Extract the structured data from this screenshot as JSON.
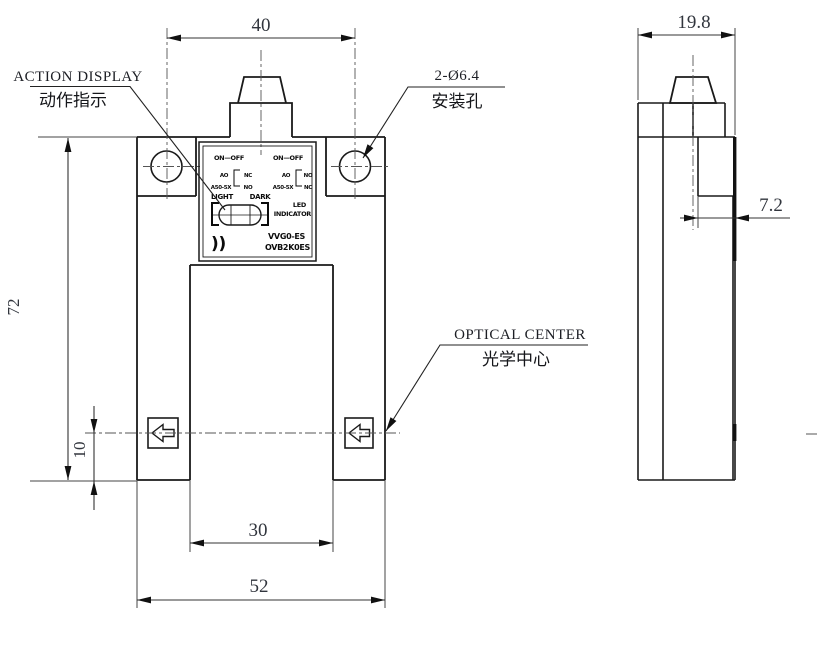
{
  "canvas": {
    "background": "#ffffff"
  },
  "colors": {
    "object_line": "#1a1a1a",
    "thin_line": "#454545",
    "centerline": "#555555",
    "dim_text": "#31353d"
  },
  "dims": {
    "hole_pitch": "40",
    "height": "72",
    "optical_offset": "10",
    "slot_width": "30",
    "width": "52",
    "depth": "19.8",
    "face_depth": "7.2"
  },
  "callouts": {
    "action_display": {
      "en": "ACTION DISPLAY",
      "zh": "动作指示"
    },
    "mounting_hole": {
      "en": "2-Ø6.4",
      "zh": "安装孔"
    },
    "optical_center": {
      "en": "OPTICAL CENTER",
      "zh": "光学中心"
    }
  },
  "plate": {
    "row1_left": "ON—OFF",
    "row1_right": "ON—OFF",
    "diagram_left": {
      "label_top": "AO",
      "label_left": "A50-5X",
      "contact_top": "NC",
      "contact_bottom": "NO"
    },
    "diagram_right": {
      "label_top": "AO",
      "label_left": "A50-5X",
      "contact_top": "NO",
      "contact_bottom": "NC"
    },
    "row3_left_a": "LIGHT",
    "row3_left_b": "DARK",
    "right_block_line1": "LED",
    "right_block_line2": "INDICATOR",
    "arcs_mark": "))",
    "model_line1": "VVG0-ES",
    "model_line2": "OVB2K0ES"
  }
}
